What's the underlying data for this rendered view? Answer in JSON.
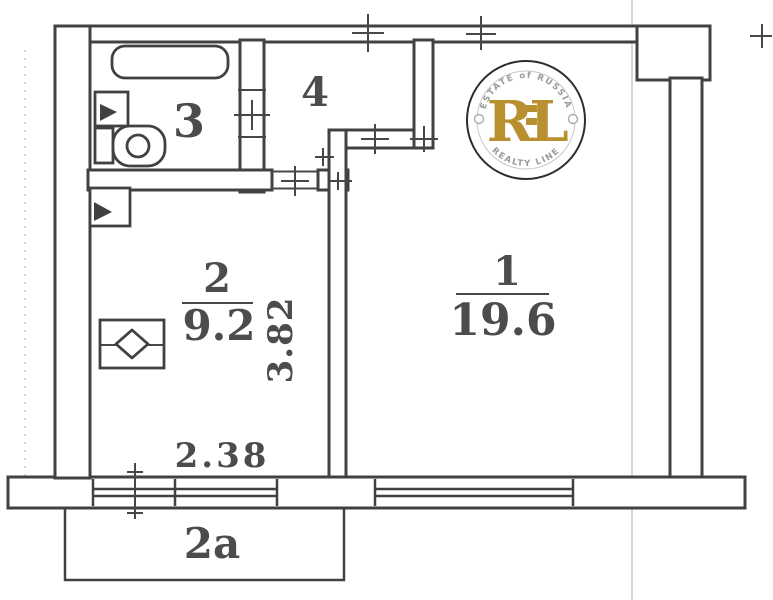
{
  "plan": {
    "kind": "floor-plan-scan",
    "rooms": {
      "room1": {
        "number": "1",
        "area": "19.6"
      },
      "room2": {
        "number": "2",
        "area": "9.2"
      },
      "room3": {
        "number": "3"
      },
      "room4": {
        "number": "4"
      },
      "balcony": {
        "number": "2a"
      }
    },
    "dimensions": {
      "bottom_width": "2.38",
      "side_height": "3.82"
    },
    "fixtures": [
      "bathtub",
      "washbasin",
      "toilet",
      "vent-hatch",
      "kitchen-sink"
    ],
    "colors": {
      "ink": "#414141",
      "paper": "#ffffff"
    }
  },
  "watermark": {
    "arc_top": "ESTATE of RUSSIA",
    "arc_bottom": "REALTY LINE",
    "letter_r": "R",
    "letter_l": "L",
    "gold": "#b9902f",
    "gray": "#9a9a9a"
  }
}
